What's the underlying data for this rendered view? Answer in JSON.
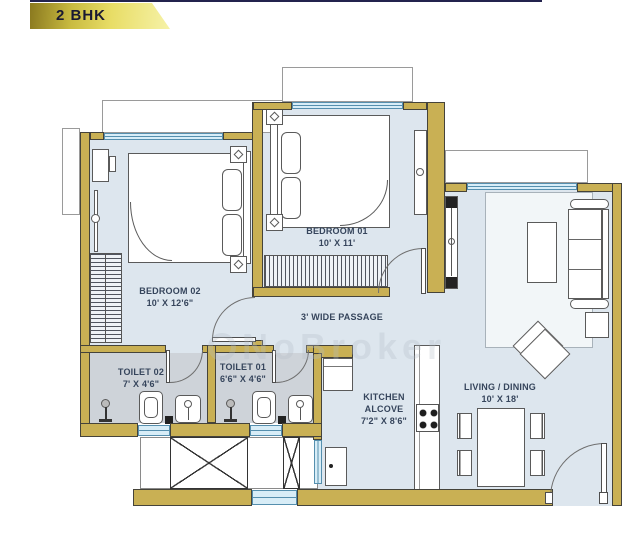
{
  "header": {
    "title": "2 BHK"
  },
  "watermark": {
    "text": "NoBroker"
  },
  "plan": {
    "bedroom_01": {
      "name": "BEDROOM 01",
      "size": "10' X 11'"
    },
    "bedroom_02": {
      "name": "BEDROOM 02",
      "size": "10' X 12'6\""
    },
    "passage": {
      "name": "3' WIDE PASSAGE"
    },
    "toilet_01": {
      "name": "TOILET 01",
      "size": "6'6\" X 4'6\""
    },
    "toilet_02": {
      "name": "TOILET 02",
      "size": "7' X 4'6\""
    },
    "kitchen": {
      "line1": "KITCHEN",
      "line2": "ALCOVE",
      "size": "7'2\" X 8'6\""
    },
    "living_dining": {
      "name": "LIVING / DINING",
      "size": "10' X 18'"
    }
  },
  "colors": {
    "wall": "#c9b054",
    "floor": "#dde6ee",
    "wet_floor": "#ced3d9",
    "window": "#d8edf7",
    "banner_gold": "#e8dd66",
    "label_text": "#36455c"
  }
}
